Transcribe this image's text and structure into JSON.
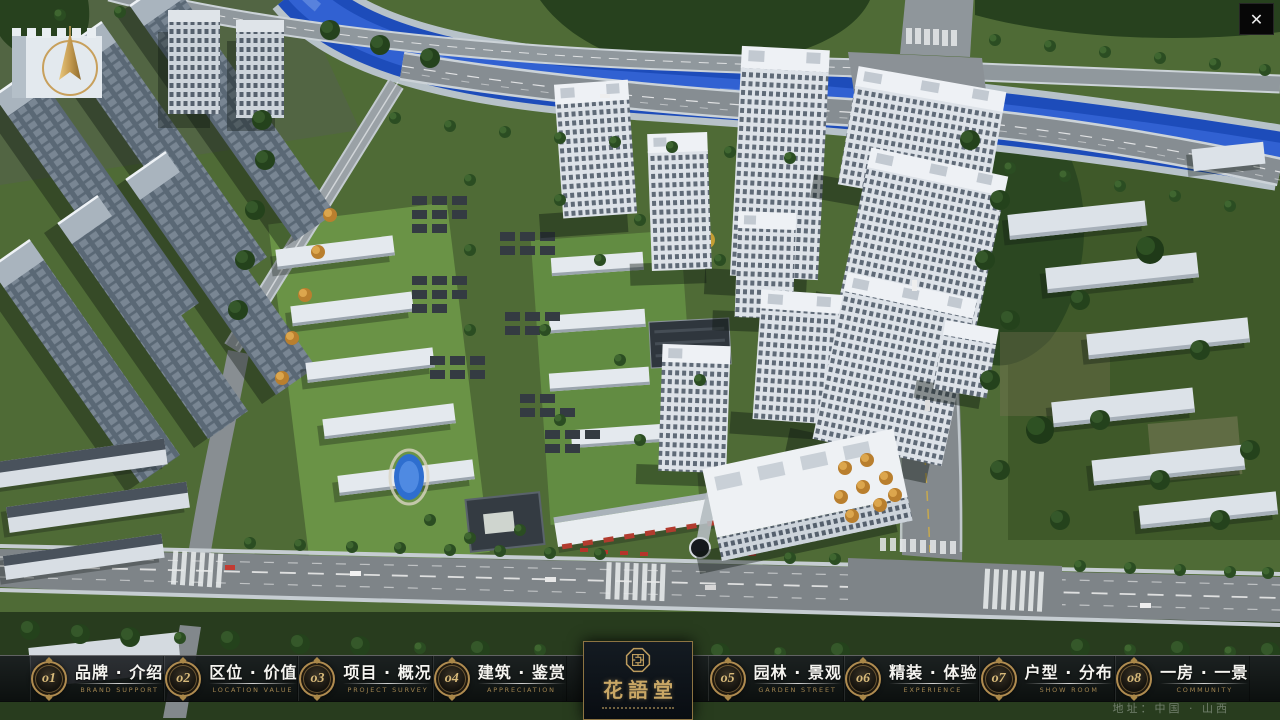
{
  "window": {
    "close_icon": "✕"
  },
  "nav": {
    "items": [
      {
        "num": "o1",
        "cn": "品牌 · 介绍",
        "en": "BRAND SUPPORT"
      },
      {
        "num": "o2",
        "cn": "区位 · 价值",
        "en": "LOCATION VALUE"
      },
      {
        "num": "o3",
        "cn": "项目 · 概况",
        "en": "PROJECT SURVEY"
      },
      {
        "num": "o4",
        "cn": "建筑 · 鉴赏",
        "en": "APPRECIATION"
      },
      {
        "num": "o5",
        "cn": "园林 · 景观",
        "en": "GARDEN STREET"
      },
      {
        "num": "o6",
        "cn": "精装 · 体验",
        "en": "EXPERIENCE"
      },
      {
        "num": "o7",
        "cn": "户型 · 分布",
        "en": "SHOW ROOM"
      },
      {
        "num": "o8",
        "cn": "一房 · 一景",
        "en": "COMMUNITY"
      }
    ]
  },
  "logo": {
    "title": "花語堂"
  },
  "footer": {
    "address": "地址：中国 · 山西"
  }
}
